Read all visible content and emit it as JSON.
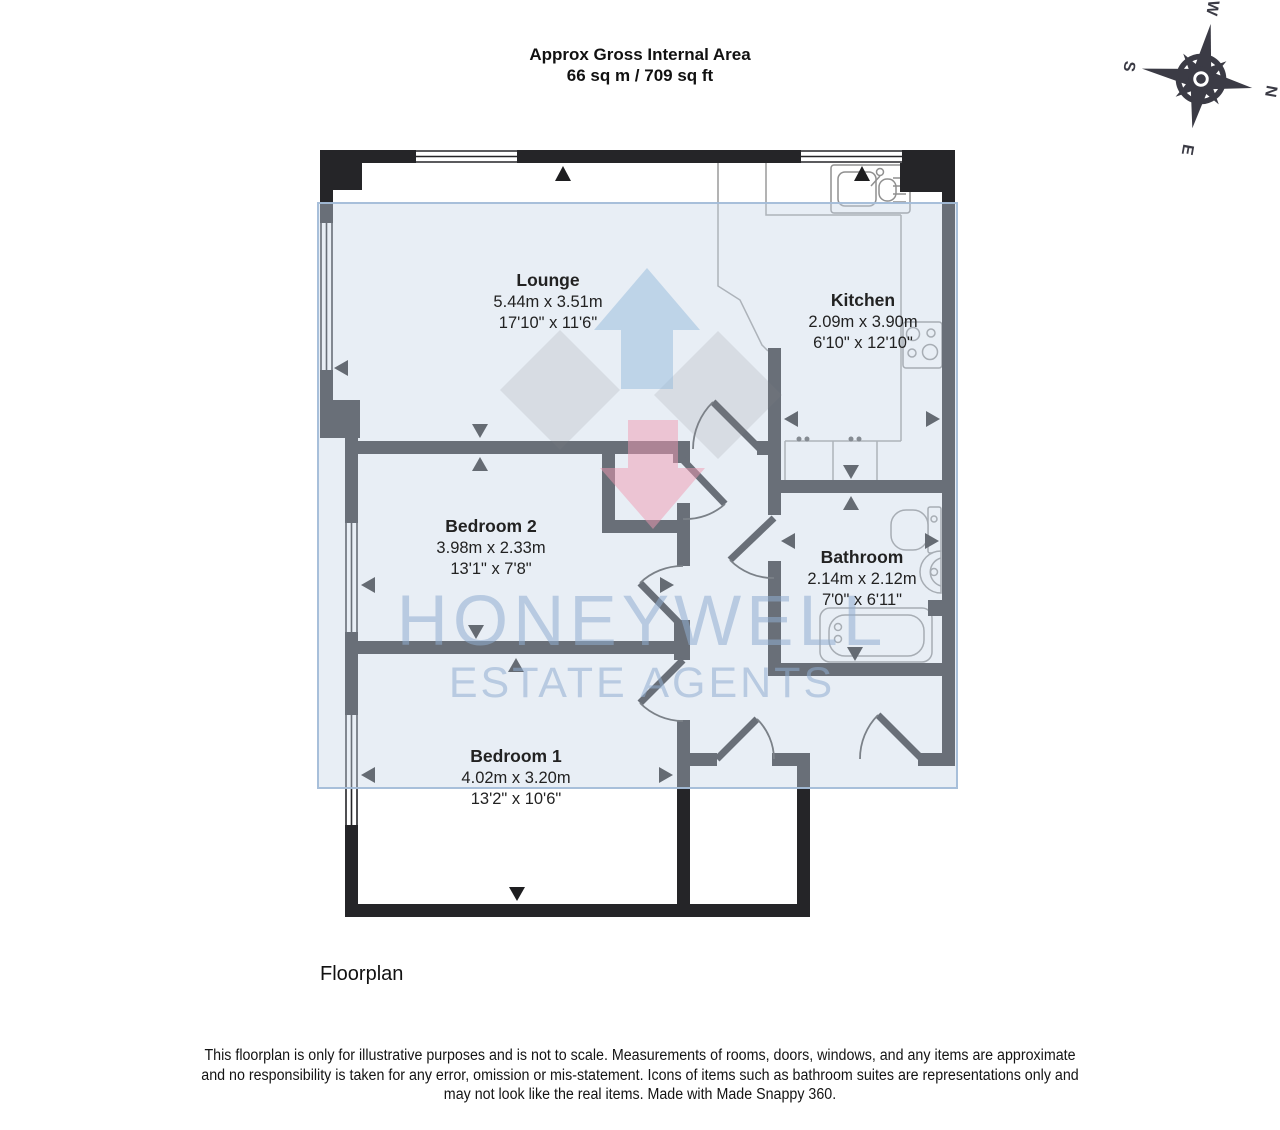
{
  "header": {
    "title": "Approx Gross Internal Area",
    "area": "66 sq m / 709 sq ft"
  },
  "compass": {
    "north": "N",
    "east": "E",
    "south": "S",
    "west": "W"
  },
  "rooms": [
    {
      "name": "Lounge",
      "metric": "5.44m x 3.51m",
      "imperial": "17'10\" x 11'6\""
    },
    {
      "name": "Kitchen",
      "metric": "2.09m x 3.90m",
      "imperial": "6'10\" x 12'10\""
    },
    {
      "name": "Bedroom 2",
      "metric": "3.98m x 2.33m",
      "imperial": "13'1\" x 7'8\""
    },
    {
      "name": "Bathroom",
      "metric": "2.14m x 2.12m",
      "imperial": "7'0\" x 6'11\""
    },
    {
      "name": "Bedroom 1",
      "metric": "4.02m x 3.20m",
      "imperial": "13'2\" x 10'6\""
    }
  ],
  "watermark": {
    "brand": "HONEYWELL",
    "tagline": "ESTATE AGENTS"
  },
  "caption": "Floorplan",
  "disclaimer": {
    "line1": "This floorplan is only for illustrative purposes and is not to scale. Measurements of rooms, doors, windows, and any items are approximate",
    "line2": "and no responsibility is taken for any error, omission or mis-statement. Icons of items such as bathroom suites are representations only and",
    "line3": "may not look like the real items. Made with Made Snappy 360."
  },
  "colors": {
    "wall": "#252528",
    "overlay_fill": "#c9d7e7",
    "overlay_border": "#a3bcd8",
    "watermark_text": "#90adcf",
    "logo_blue": "#94badc",
    "logo_pink": "#f09ab2",
    "fixture_line": "#8f8f8f",
    "compass": "#3b3b45"
  }
}
